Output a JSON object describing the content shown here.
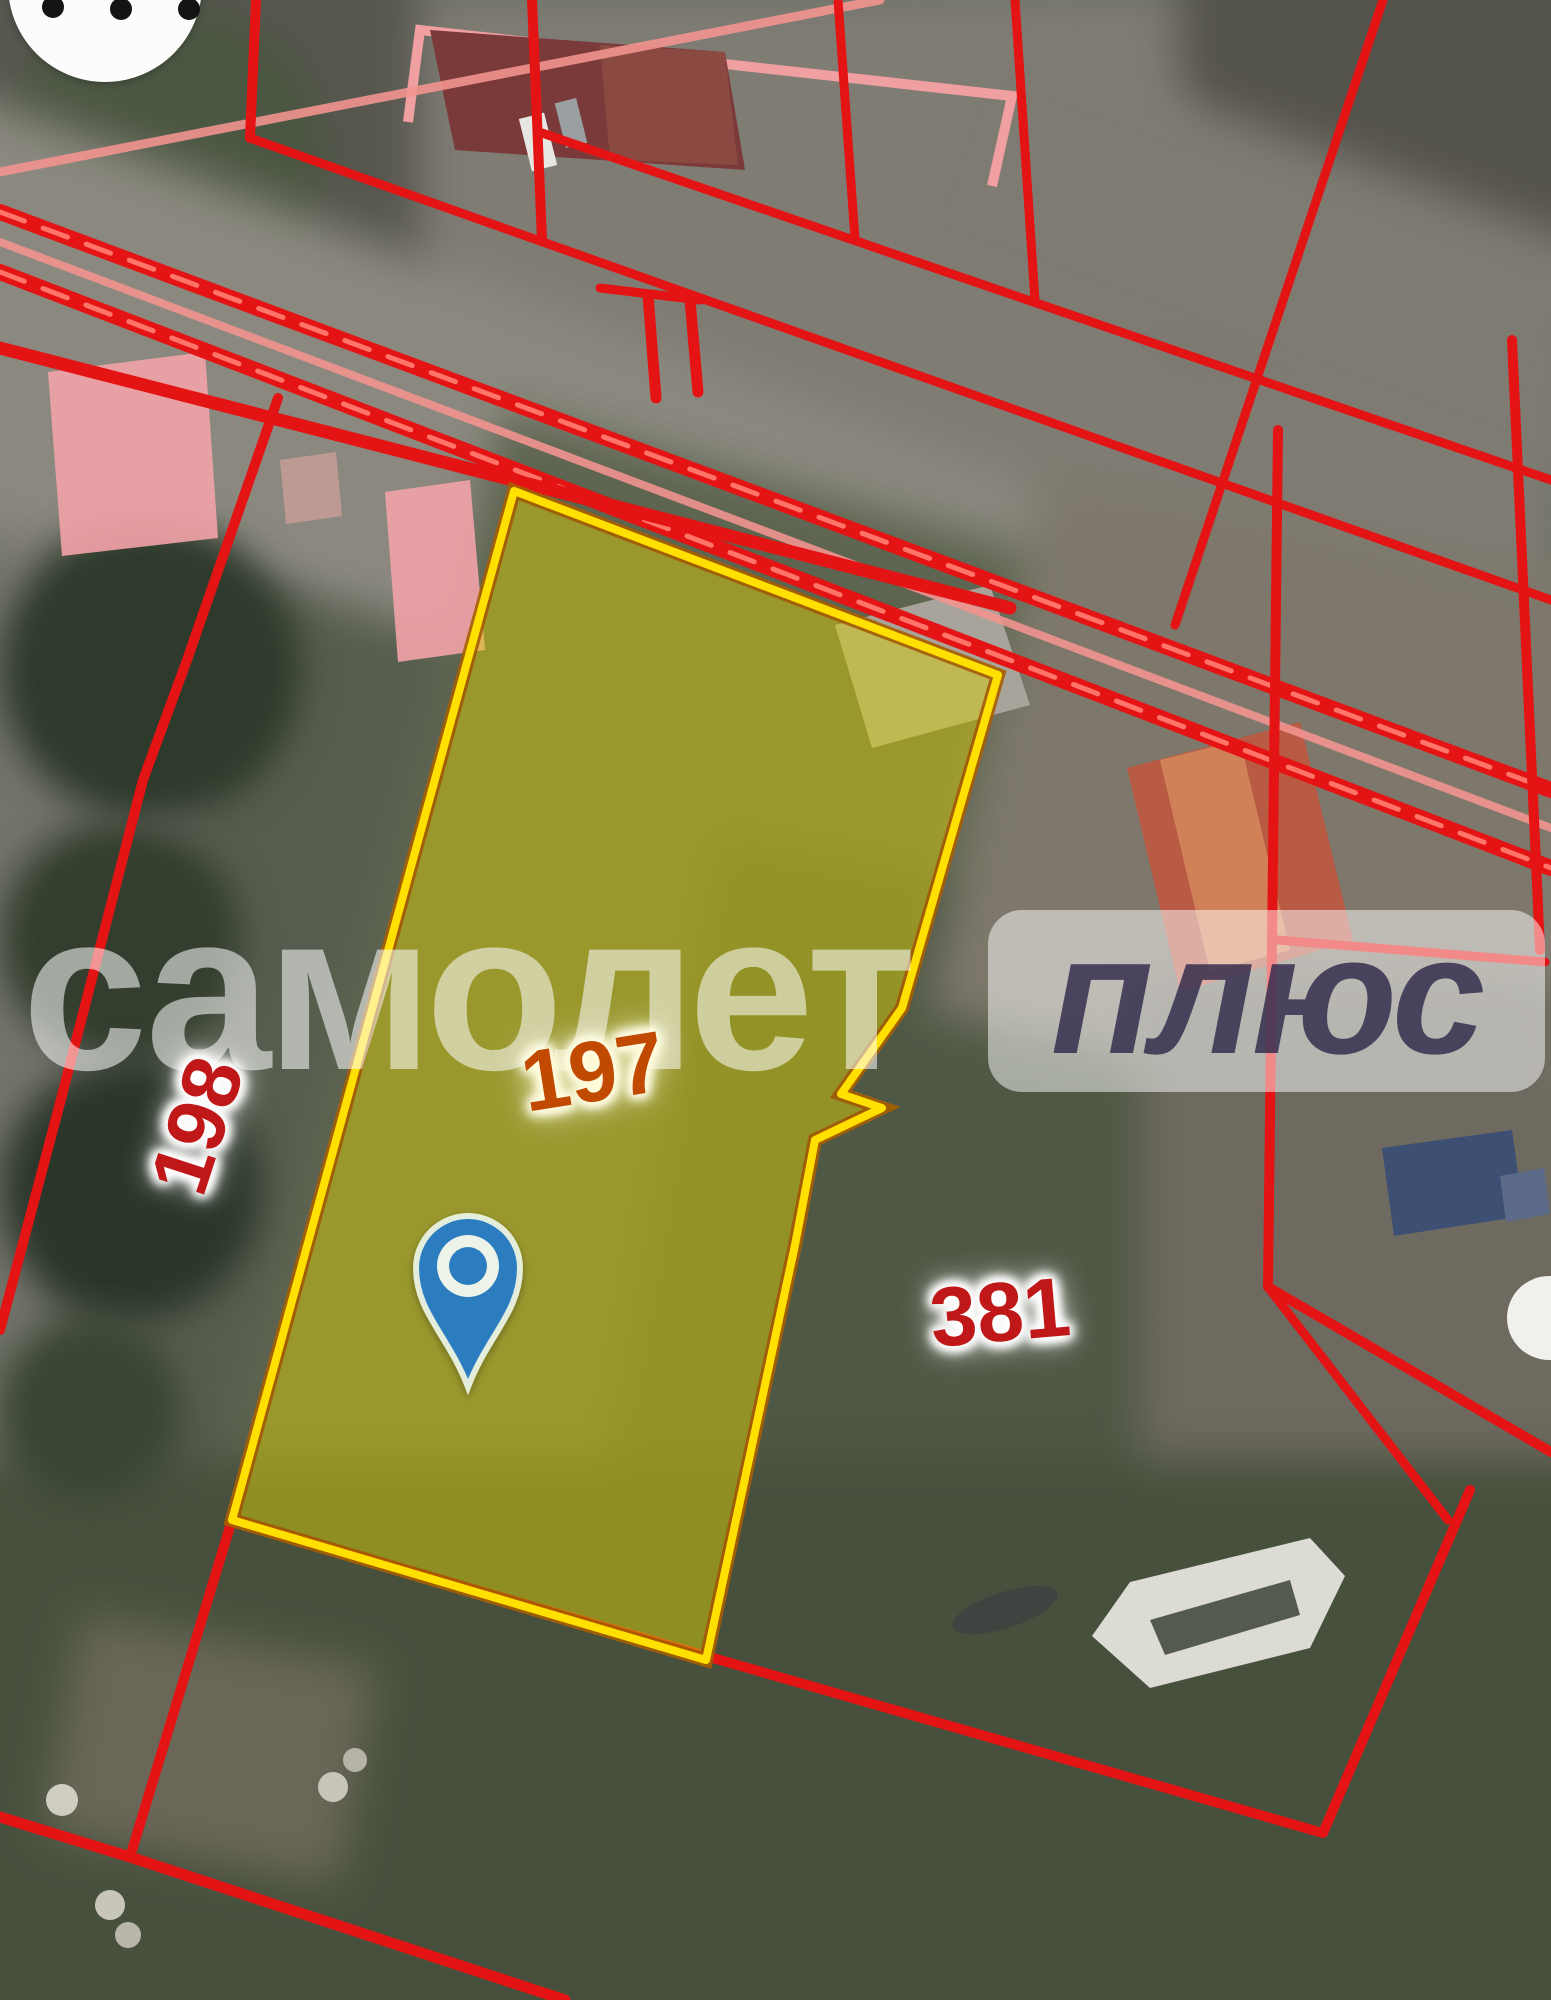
{
  "app": {
    "view": "satellite-cadastral-map"
  },
  "watermark": {
    "brand_part1": "самолет",
    "brand_part2": "плюс"
  },
  "map": {
    "highlighted_parcel": {
      "number": "197",
      "fill_color": "#d6cd10",
      "border_color": "#ffe000",
      "label_color": "#c24a00"
    },
    "adjacent_parcels": [
      {
        "number": "198",
        "label_color": "#c01818"
      },
      {
        "number": "381",
        "label_color": "#c01818"
      }
    ],
    "boundary_color": "#e41414",
    "road_line_color": "#f2938f",
    "marker": {
      "type": "location-pin",
      "color": "#2b7dc0"
    },
    "controls": {
      "more_button_icon": "more-options"
    }
  }
}
